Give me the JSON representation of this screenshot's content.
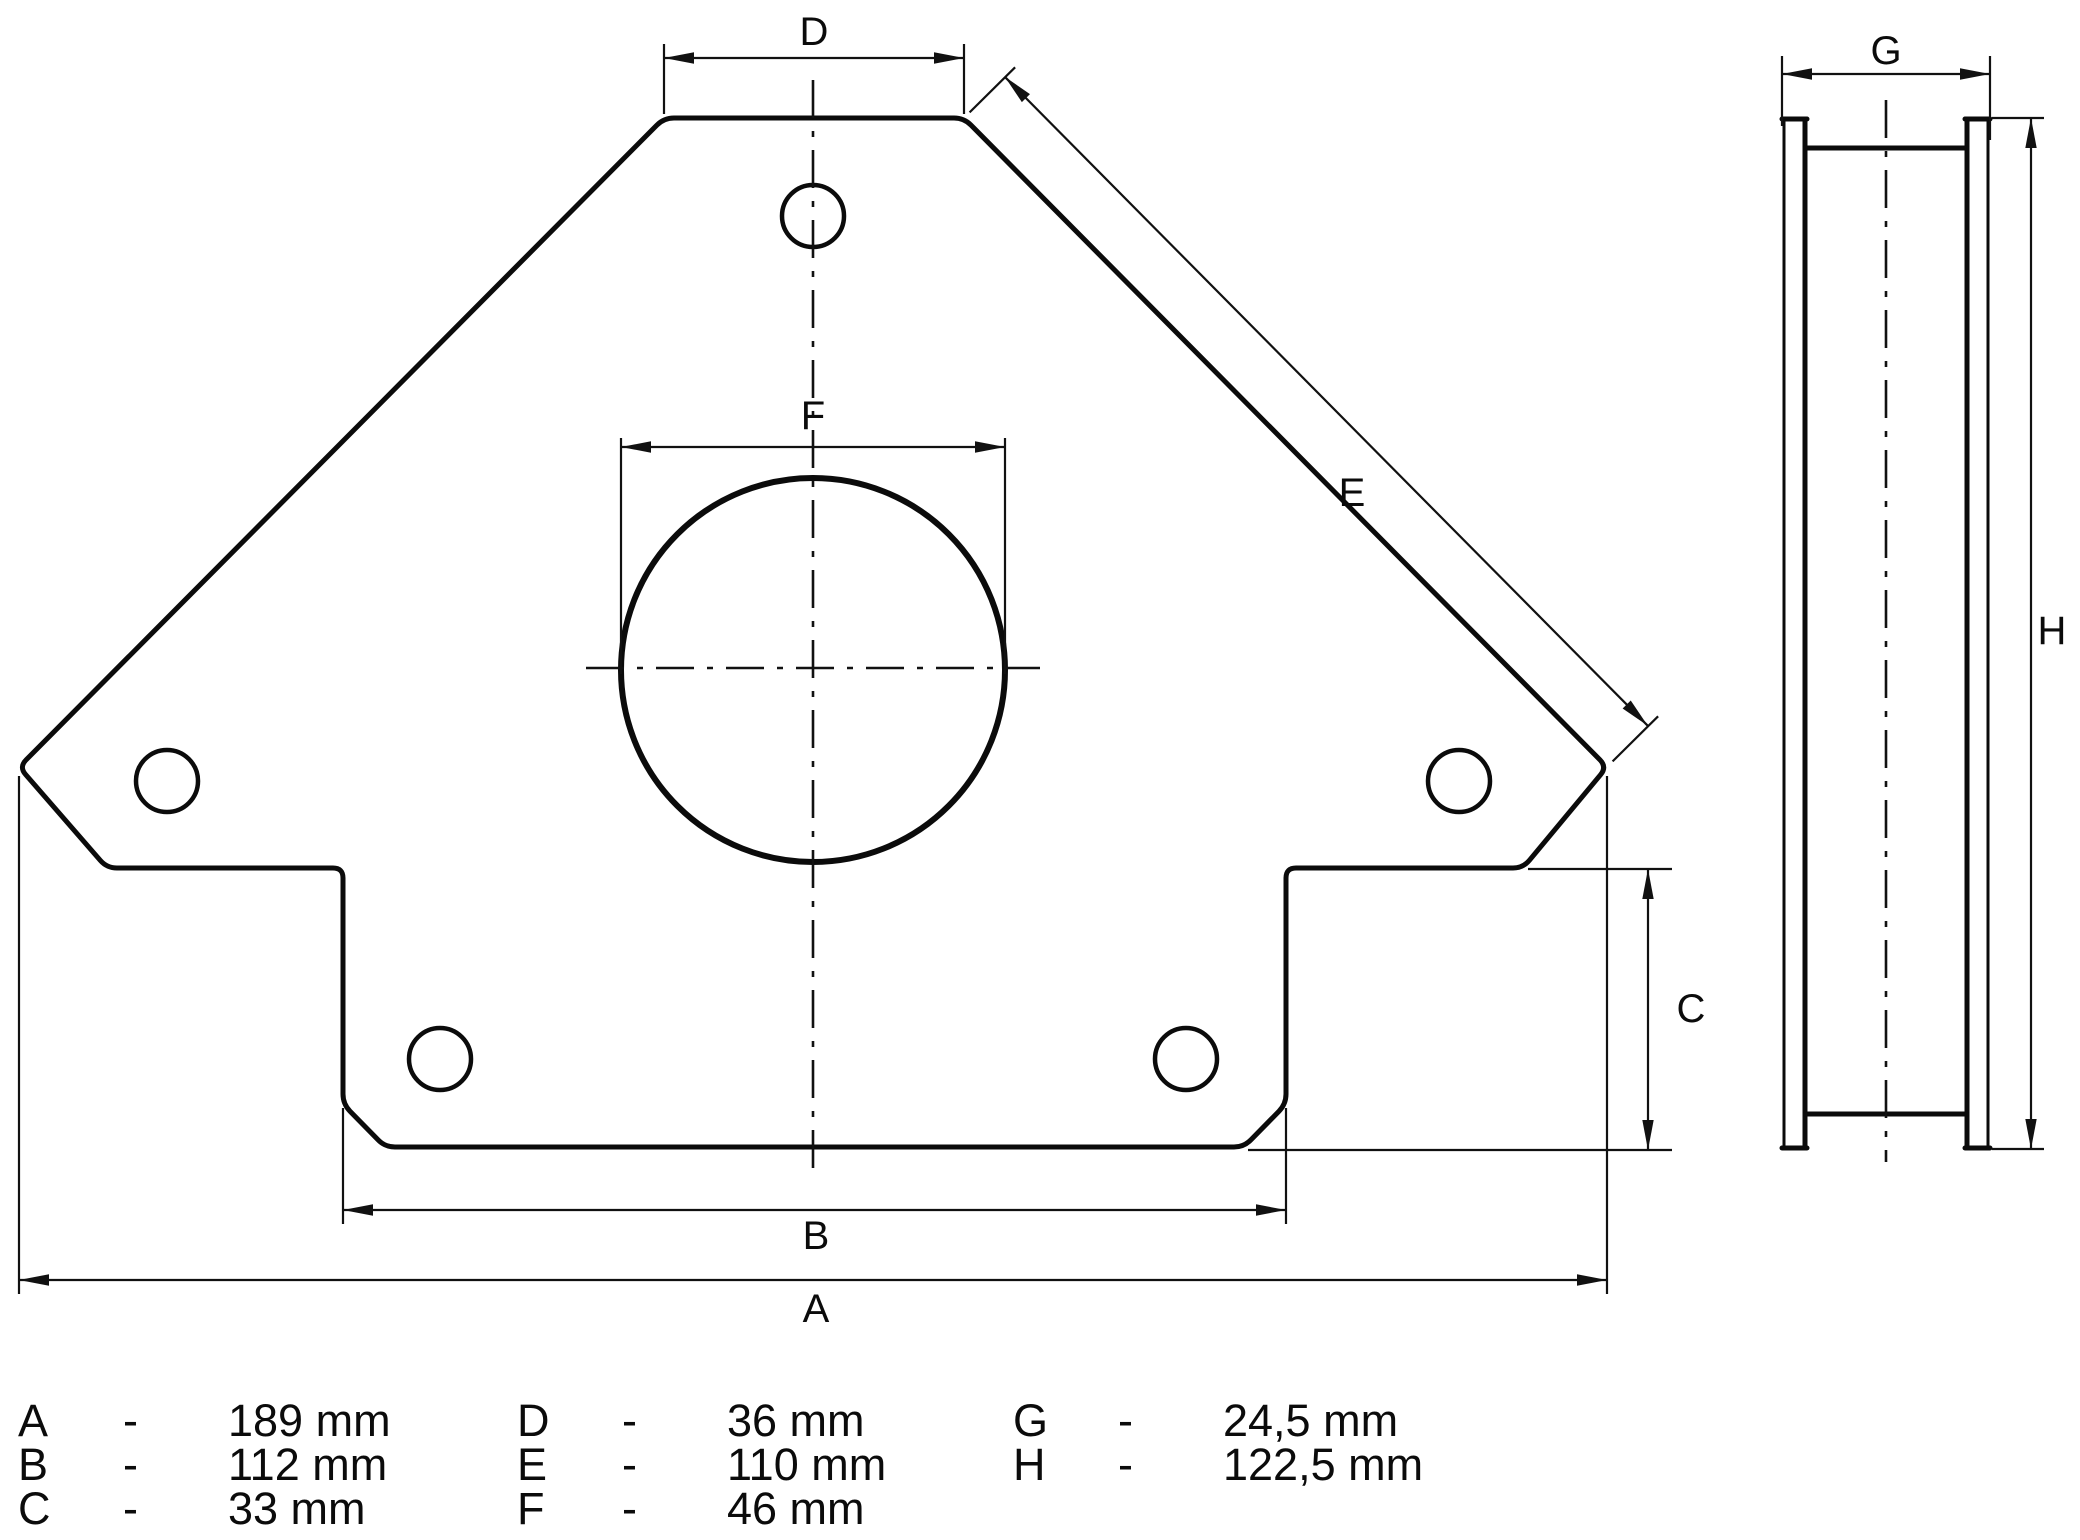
{
  "colors": {
    "ink": "#0b0b0b",
    "background": "#ffffff"
  },
  "front_view": {
    "labels": {
      "a": "A",
      "b": "B",
      "c": "C",
      "d": "D",
      "e": "E",
      "f": "F"
    }
  },
  "side_view": {
    "labels": {
      "g": "G",
      "h": "H"
    }
  },
  "legend": {
    "items": [
      {
        "letter": "A",
        "separator": "-",
        "value": "189 mm"
      },
      {
        "letter": "B",
        "separator": "-",
        "value": "112 mm"
      },
      {
        "letter": "C",
        "separator": "-",
        "value": "33 mm"
      },
      {
        "letter": "D",
        "separator": "-",
        "value": "36 mm"
      },
      {
        "letter": "E",
        "separator": "-",
        "value": "110 mm"
      },
      {
        "letter": "F",
        "separator": "-",
        "value": "46 mm"
      },
      {
        "letter": "G",
        "separator": "-",
        "value": "24,5 mm"
      },
      {
        "letter": "H",
        "separator": "-",
        "value": "122,5 mm"
      }
    ]
  }
}
